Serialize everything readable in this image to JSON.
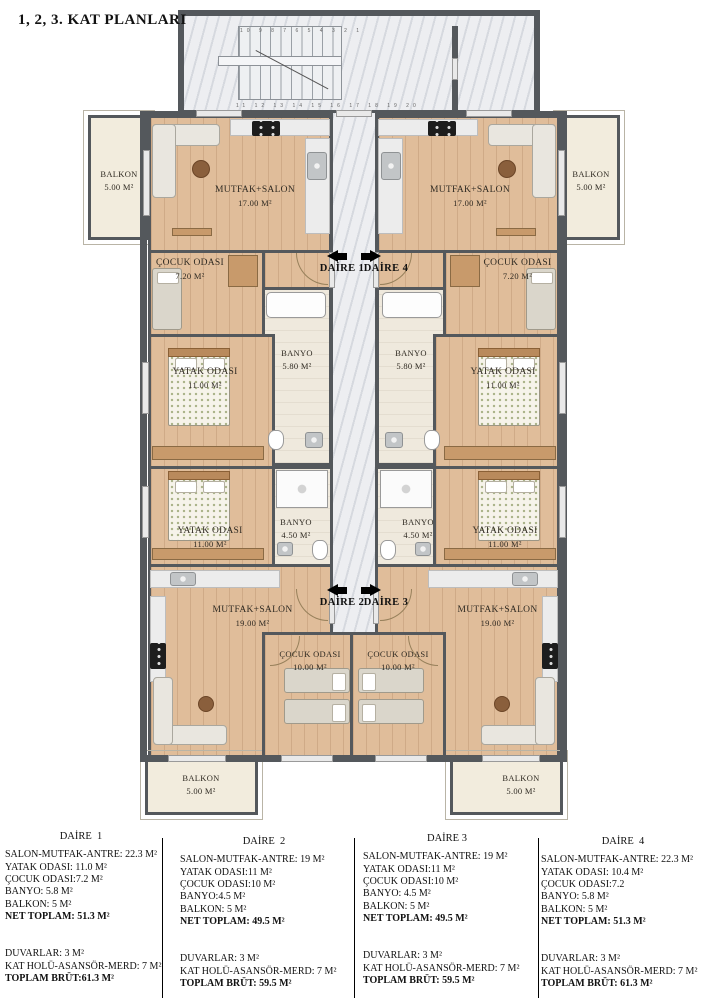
{
  "title": "1, 2, 3. KAT PLANLARI",
  "plan": {
    "arrows": {
      "daire1": "DAİRE 1",
      "daire2": "DAİRE 2",
      "daire3": "DAİRE 3",
      "daire4": "DAİRE 4"
    },
    "stairs": {
      "numbers_top": "10 9 8 7 6 5 4 3 2 1",
      "numbers_bottom": "11 12 13 14 15 16 17 18 19 20"
    },
    "rooms": {
      "d1_salon": {
        "name": "MUTFAK+SALON",
        "area": "17.00 M²"
      },
      "d1_cocuk": {
        "name": "ÇOCUK ODASI",
        "area": "7.20 M²"
      },
      "d1_banyo": {
        "name": "BANYO",
        "area": "5.80 M²"
      },
      "d1_yatak": {
        "name": "YATAK ODASI",
        "area": "11.00 M²"
      },
      "d1_balkon": {
        "name": "BALKON",
        "area": "5.00 M²"
      },
      "d2_yatak": {
        "name": "YATAK ODASI",
        "area": "11.00 M²"
      },
      "d2_banyo": {
        "name": "BANYO",
        "area": "4.50 M²"
      },
      "d2_salon": {
        "name": "MUTFAK+SALON",
        "area": "19.00 M²"
      },
      "d2_cocuk": {
        "name": "ÇOCUK ODASI",
        "area": "10.00 M²"
      },
      "d2_balkon": {
        "name": "BALKON",
        "area": "5.00 M²"
      },
      "d4_salon": {
        "name": "MUTFAK+SALON",
        "area": "17.00 M²"
      },
      "d4_cocuk": {
        "name": "ÇOCUK ODASI",
        "area": "7.20 M²"
      },
      "d4_banyo": {
        "name": "BANYO",
        "area": "5.80 M²"
      },
      "d4_yatak": {
        "name": "YATAK ODASI",
        "area": "11.00 M²"
      },
      "d4_balkon": {
        "name": "BALKON",
        "area": "5.00 M²"
      },
      "d3_yatak": {
        "name": "YATAK ODASI",
        "area": "11.00 M²"
      },
      "d3_banyo": {
        "name": "BANYO",
        "area": "4.50 M²"
      },
      "d3_salon": {
        "name": "MUTFAK+SALON",
        "area": "19.00 M²"
      },
      "d3_cocuk": {
        "name": "ÇOCUK ODASI",
        "area": "10.00 M²"
      },
      "d3_balkon": {
        "name": "BALKON",
        "area": "5.00 M²"
      }
    },
    "colors": {
      "wall": "#54585c",
      "wood_floor": "#e0bd9a",
      "marble": "#edeef1",
      "balcony": "#f2ecdd"
    }
  },
  "legend": {
    "columns": [
      {
        "title": "DAİRE  1",
        "rows": [
          "SALON-MUTFAK-ANTRE: 22.3 M²",
          "YATAK ODASI: 11.0 M²",
          "ÇOCUK ODASI:7.2 M²",
          "BANYO: 5.8 M²",
          "BALKON: 5 M²"
        ],
        "net_total": "NET TOPLAM: 51.3 M²",
        "extras": [
          "DUVARLAR: 3 M²",
          "KAT HOLÜ-ASANSÖR-MERD: 7 M²"
        ],
        "gross_total": "TOPLAM BRÜT:61.3 M²"
      },
      {
        "title": "DAİRE  2",
        "rows": [
          "SALON-MUTFAK-ANTRE: 19 M²",
          "YATAK ODASI:11 M²",
          "ÇOCUK ODASI:10 M²",
          "BANYO:4.5 M²",
          "BALKON: 5 M²"
        ],
        "net_total": "NET TOPLAM: 49.5 M²",
        "extras": [
          "DUVARLAR: 3 M²",
          "KAT HOLÜ-ASANSÖR-MERD: 7 M²"
        ],
        "gross_total": "TOPLAM BRÜT: 59.5 M²"
      },
      {
        "title": "DAİRE 3",
        "rows": [
          "SALON-MUTFAK-ANTRE: 19 M²",
          "YATAK ODASI:11 M²",
          "ÇOCUK ODASI:10 M²",
          "BANYO: 4.5 M²",
          "BALKON: 5 M²"
        ],
        "net_total": "NET TOPLAM: 49.5 M²",
        "extras": [
          "DUVARLAR: 3 M²",
          "KAT HOLÜ-ASANSÖR-MERD: 7 M²"
        ],
        "gross_total": "TOPLAM BRÜT: 59.5 M²"
      },
      {
        "title": "DAİRE  4",
        "rows": [
          "SALON-MUTFAK-ANTRE: 22.3 M²",
          "YATAK ODASI: 10.4 M²",
          "ÇOCUK ODASI:7.2",
          "BANYO: 5.8 M²",
          "BALKON: 5 M²"
        ],
        "net_total": "NET TOPLAM: 51.3 M²",
        "extras": [
          "DUVARLAR: 3 M²",
          "KAT HOLÜ-ASANSÖR-MERD: 7 M²"
        ],
        "gross_total": "TOPLAM BRÜT: 61.3 M²"
      }
    ]
  }
}
